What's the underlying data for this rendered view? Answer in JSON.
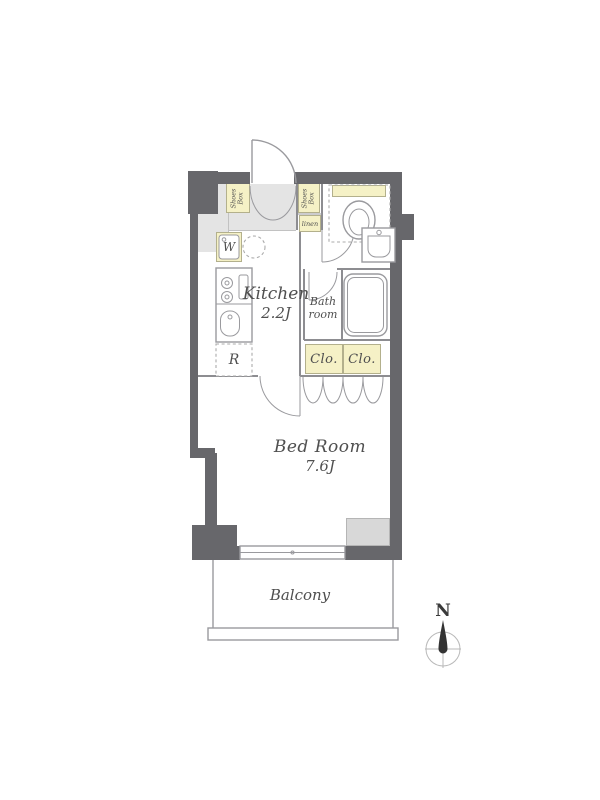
{
  "colors": {
    "wall": "#67676b",
    "fixture": "#f5f1c6",
    "fixborder": "#b3b08c",
    "entry": "#e4e4e4",
    "block": "#d8d8d8",
    "line": "#9a9a9e",
    "line2": "#8d8d91",
    "dash": "#ababab",
    "text": "#4f4f4f",
    "compass": "#b8b8b8",
    "needle": "#333333"
  },
  "labels": {
    "shoes_box_left": {
      "line1": "Shoes",
      "line2": "Box"
    },
    "shoes_box_right": {
      "line1": "Shoes",
      "line2": "Box"
    },
    "linen": "linen",
    "washer": "W",
    "refrigerator": "R",
    "kitchen": {
      "name": "Kitchen",
      "size": "2.2J"
    },
    "bath": {
      "line1": "Bath",
      "line2": "room"
    },
    "closet_left": "Clo.",
    "closet_right": "Clo.",
    "bedroom": {
      "name": "Bed Room",
      "size": "7.6J"
    },
    "balcony": "Balcony",
    "compass_north": "N"
  }
}
